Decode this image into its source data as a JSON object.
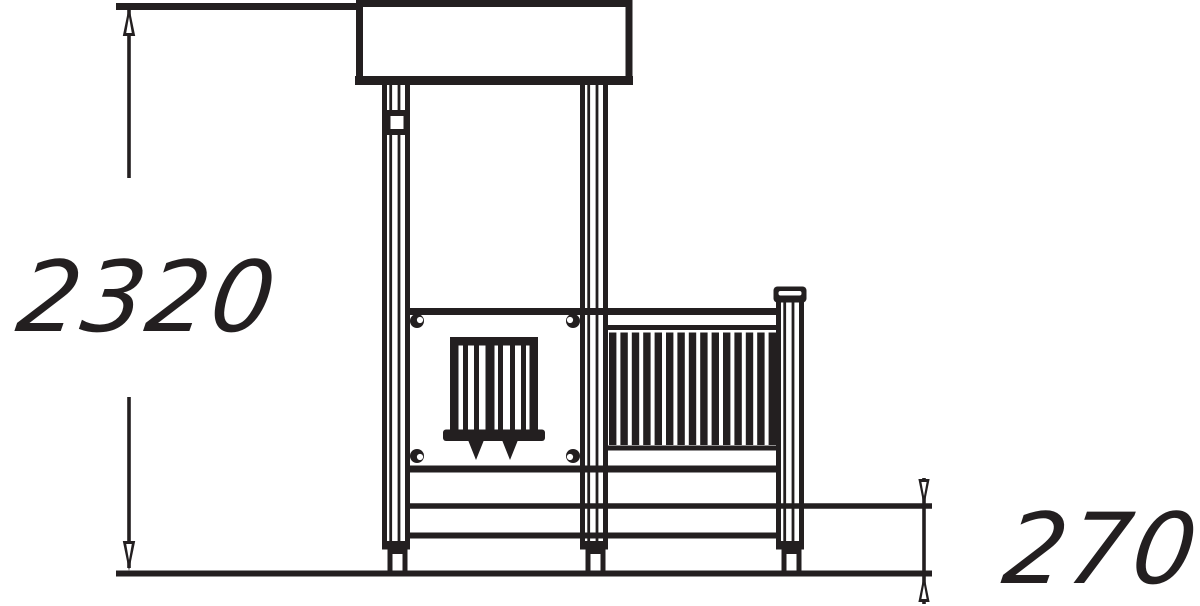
{
  "drawing": {
    "description": "CAD side elevation of a playground tower with roof panel, play panel, railing and platform",
    "ink_color": "#231f20",
    "background_color": "#ffffff"
  },
  "dimensions": {
    "overall_height": "2320",
    "platform_height": "270"
  },
  "structure": {
    "baluster_count": 15,
    "slat_count": 6
  }
}
